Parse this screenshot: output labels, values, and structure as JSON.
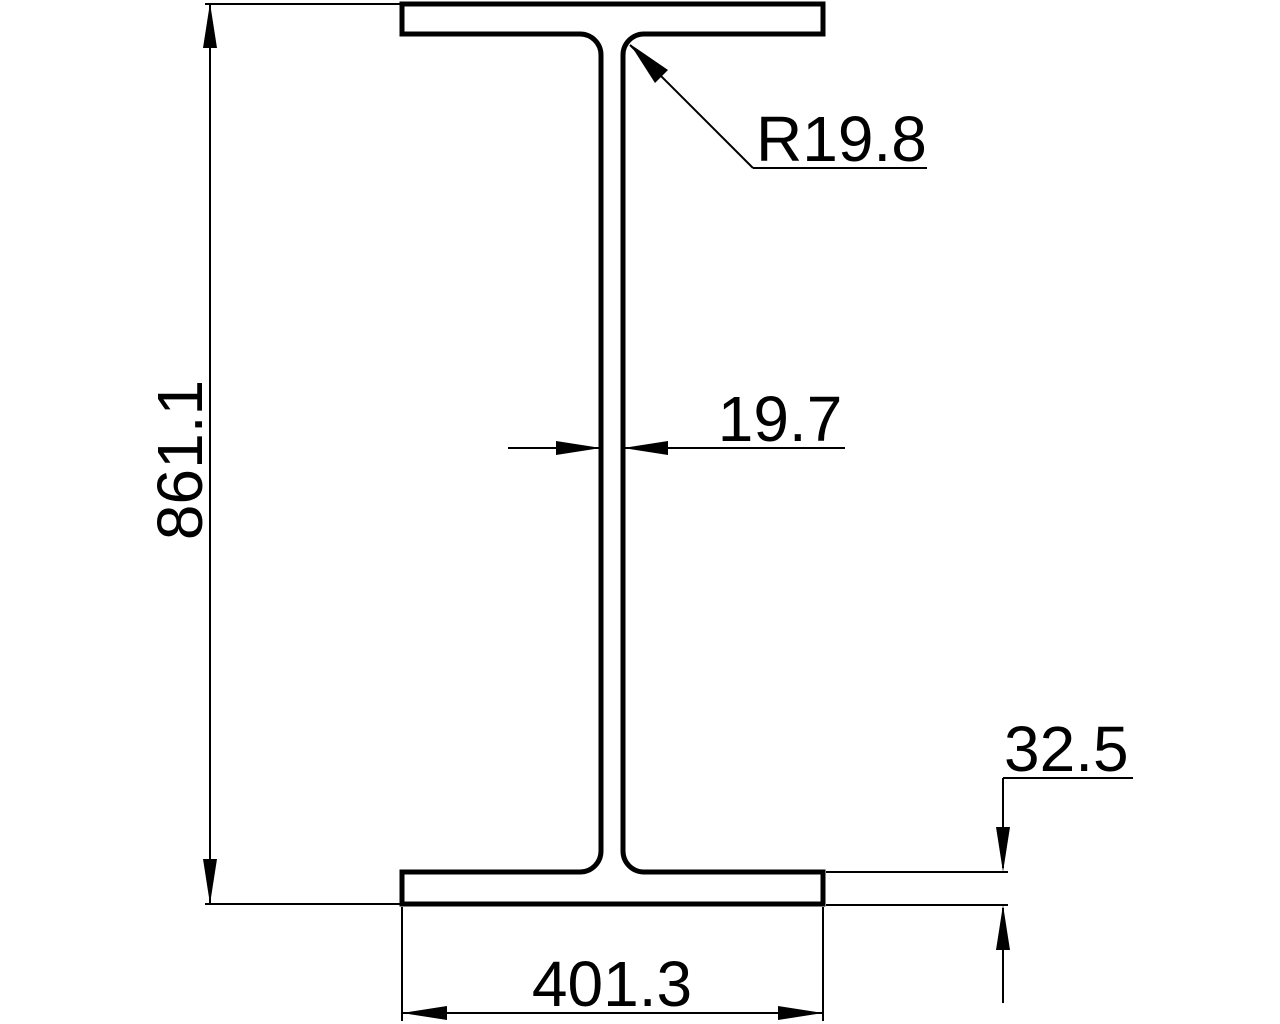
{
  "colors": {
    "ink": "#000000",
    "background": "#ffffff"
  },
  "drawing": {
    "dimensions": {
      "height": "861.1",
      "flange_width": "401.3",
      "flange_thickness": "32.5",
      "web_thickness": "19.7",
      "fillet_radius": "R19.8"
    }
  }
}
